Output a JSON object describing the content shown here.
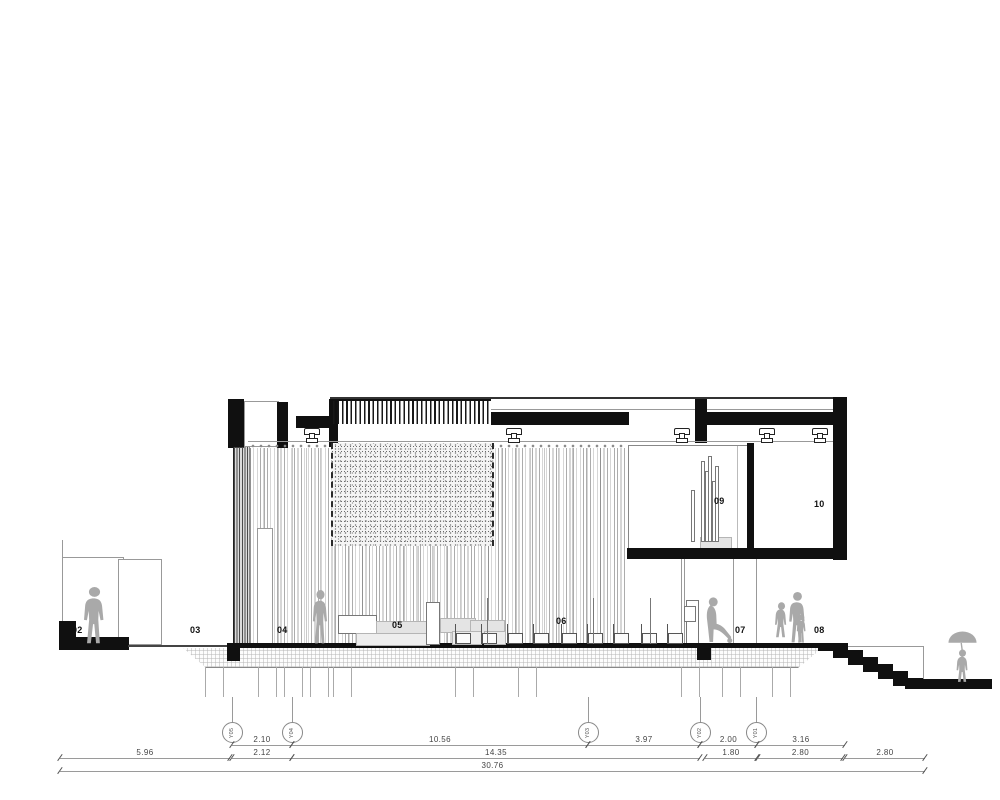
{
  "drawing": {
    "title": "building longitudinal section",
    "room_labels": {
      "r02": "02",
      "r03": "03",
      "r04": "04",
      "r05": "05",
      "r06": "06",
      "r07": "07",
      "r08": "08",
      "r09": "09",
      "r10": "10"
    },
    "grid_bubbles": [
      "Y05",
      "Y04",
      "Y03",
      "Y02",
      "Y01"
    ],
    "dimensions": {
      "row1": [
        "2.10",
        "10.56",
        "3.97",
        "2.00",
        "3.16"
      ],
      "row2": [
        "5.96",
        "2.12",
        "14.35",
        "1.80",
        "2.80",
        "2.80"
      ],
      "total": "30.76"
    },
    "colors": {
      "ink": "#101010",
      "line_gray": "#999999",
      "figure_gray": "#a9a9a9",
      "furniture_gray": "#e4e4e4"
    }
  }
}
